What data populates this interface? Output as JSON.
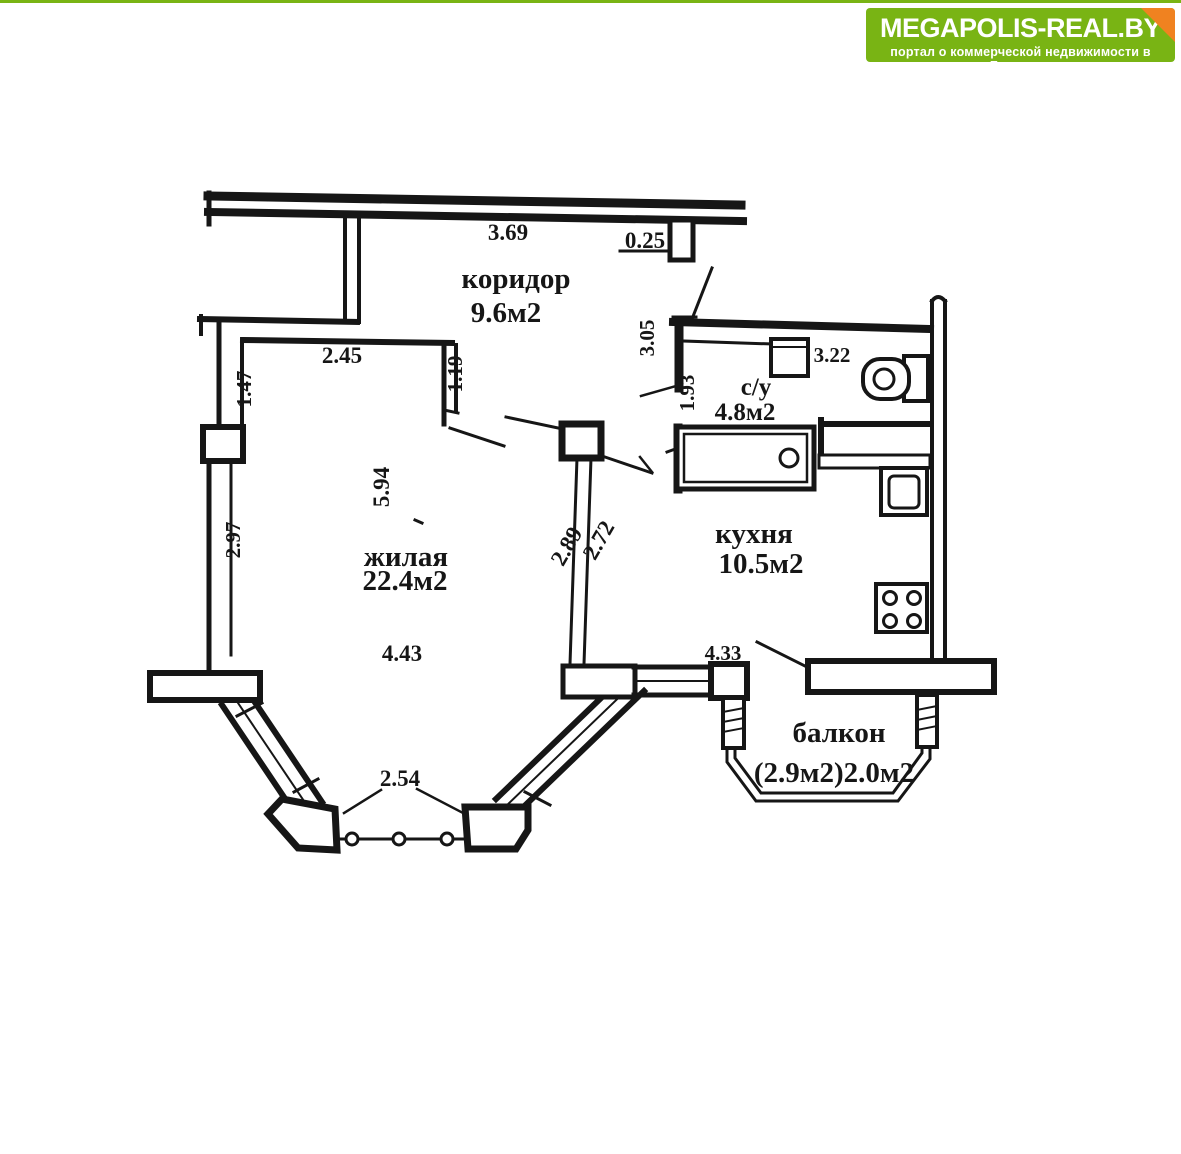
{
  "logo": {
    "title": "MEGAPOLIS-REAL.BY",
    "subtitle": "портал о коммерческой недвижимости в Беларуси",
    "bg_color": "#79b414",
    "corner_color": "#f08220",
    "text_color": "#ffffff"
  },
  "floorplan": {
    "line_color": "#161616",
    "rooms": {
      "corridor": {
        "name": "коридор",
        "area": "9.6м2"
      },
      "bathroom": {
        "name": "с/у",
        "area": "4.8м2"
      },
      "living": {
        "name": "жилая",
        "area": "22.4м2"
      },
      "kitchen": {
        "name": "кухня",
        "area": "10.5м2"
      },
      "balcony": {
        "name": "балкон",
        "area": "(2.9м2)2.0м2"
      }
    },
    "dimensions": {
      "corridor_length": "3.69",
      "wall_niche": "0.25",
      "entry_width": "2.45",
      "entry_depth": "1.19",
      "living_wall_upper": "1.47",
      "living_wall_lower": "2.97",
      "living_length": "5.94",
      "living_width": "4.43",
      "bay_window_width": "2.54",
      "divider_wall_a": "2.89",
      "divider_wall_b": "2.72",
      "bathroom_length": "3.05",
      "bathroom_door": "1.93",
      "bathroom_width": "3.22",
      "kitchen_width": "4.33"
    }
  }
}
